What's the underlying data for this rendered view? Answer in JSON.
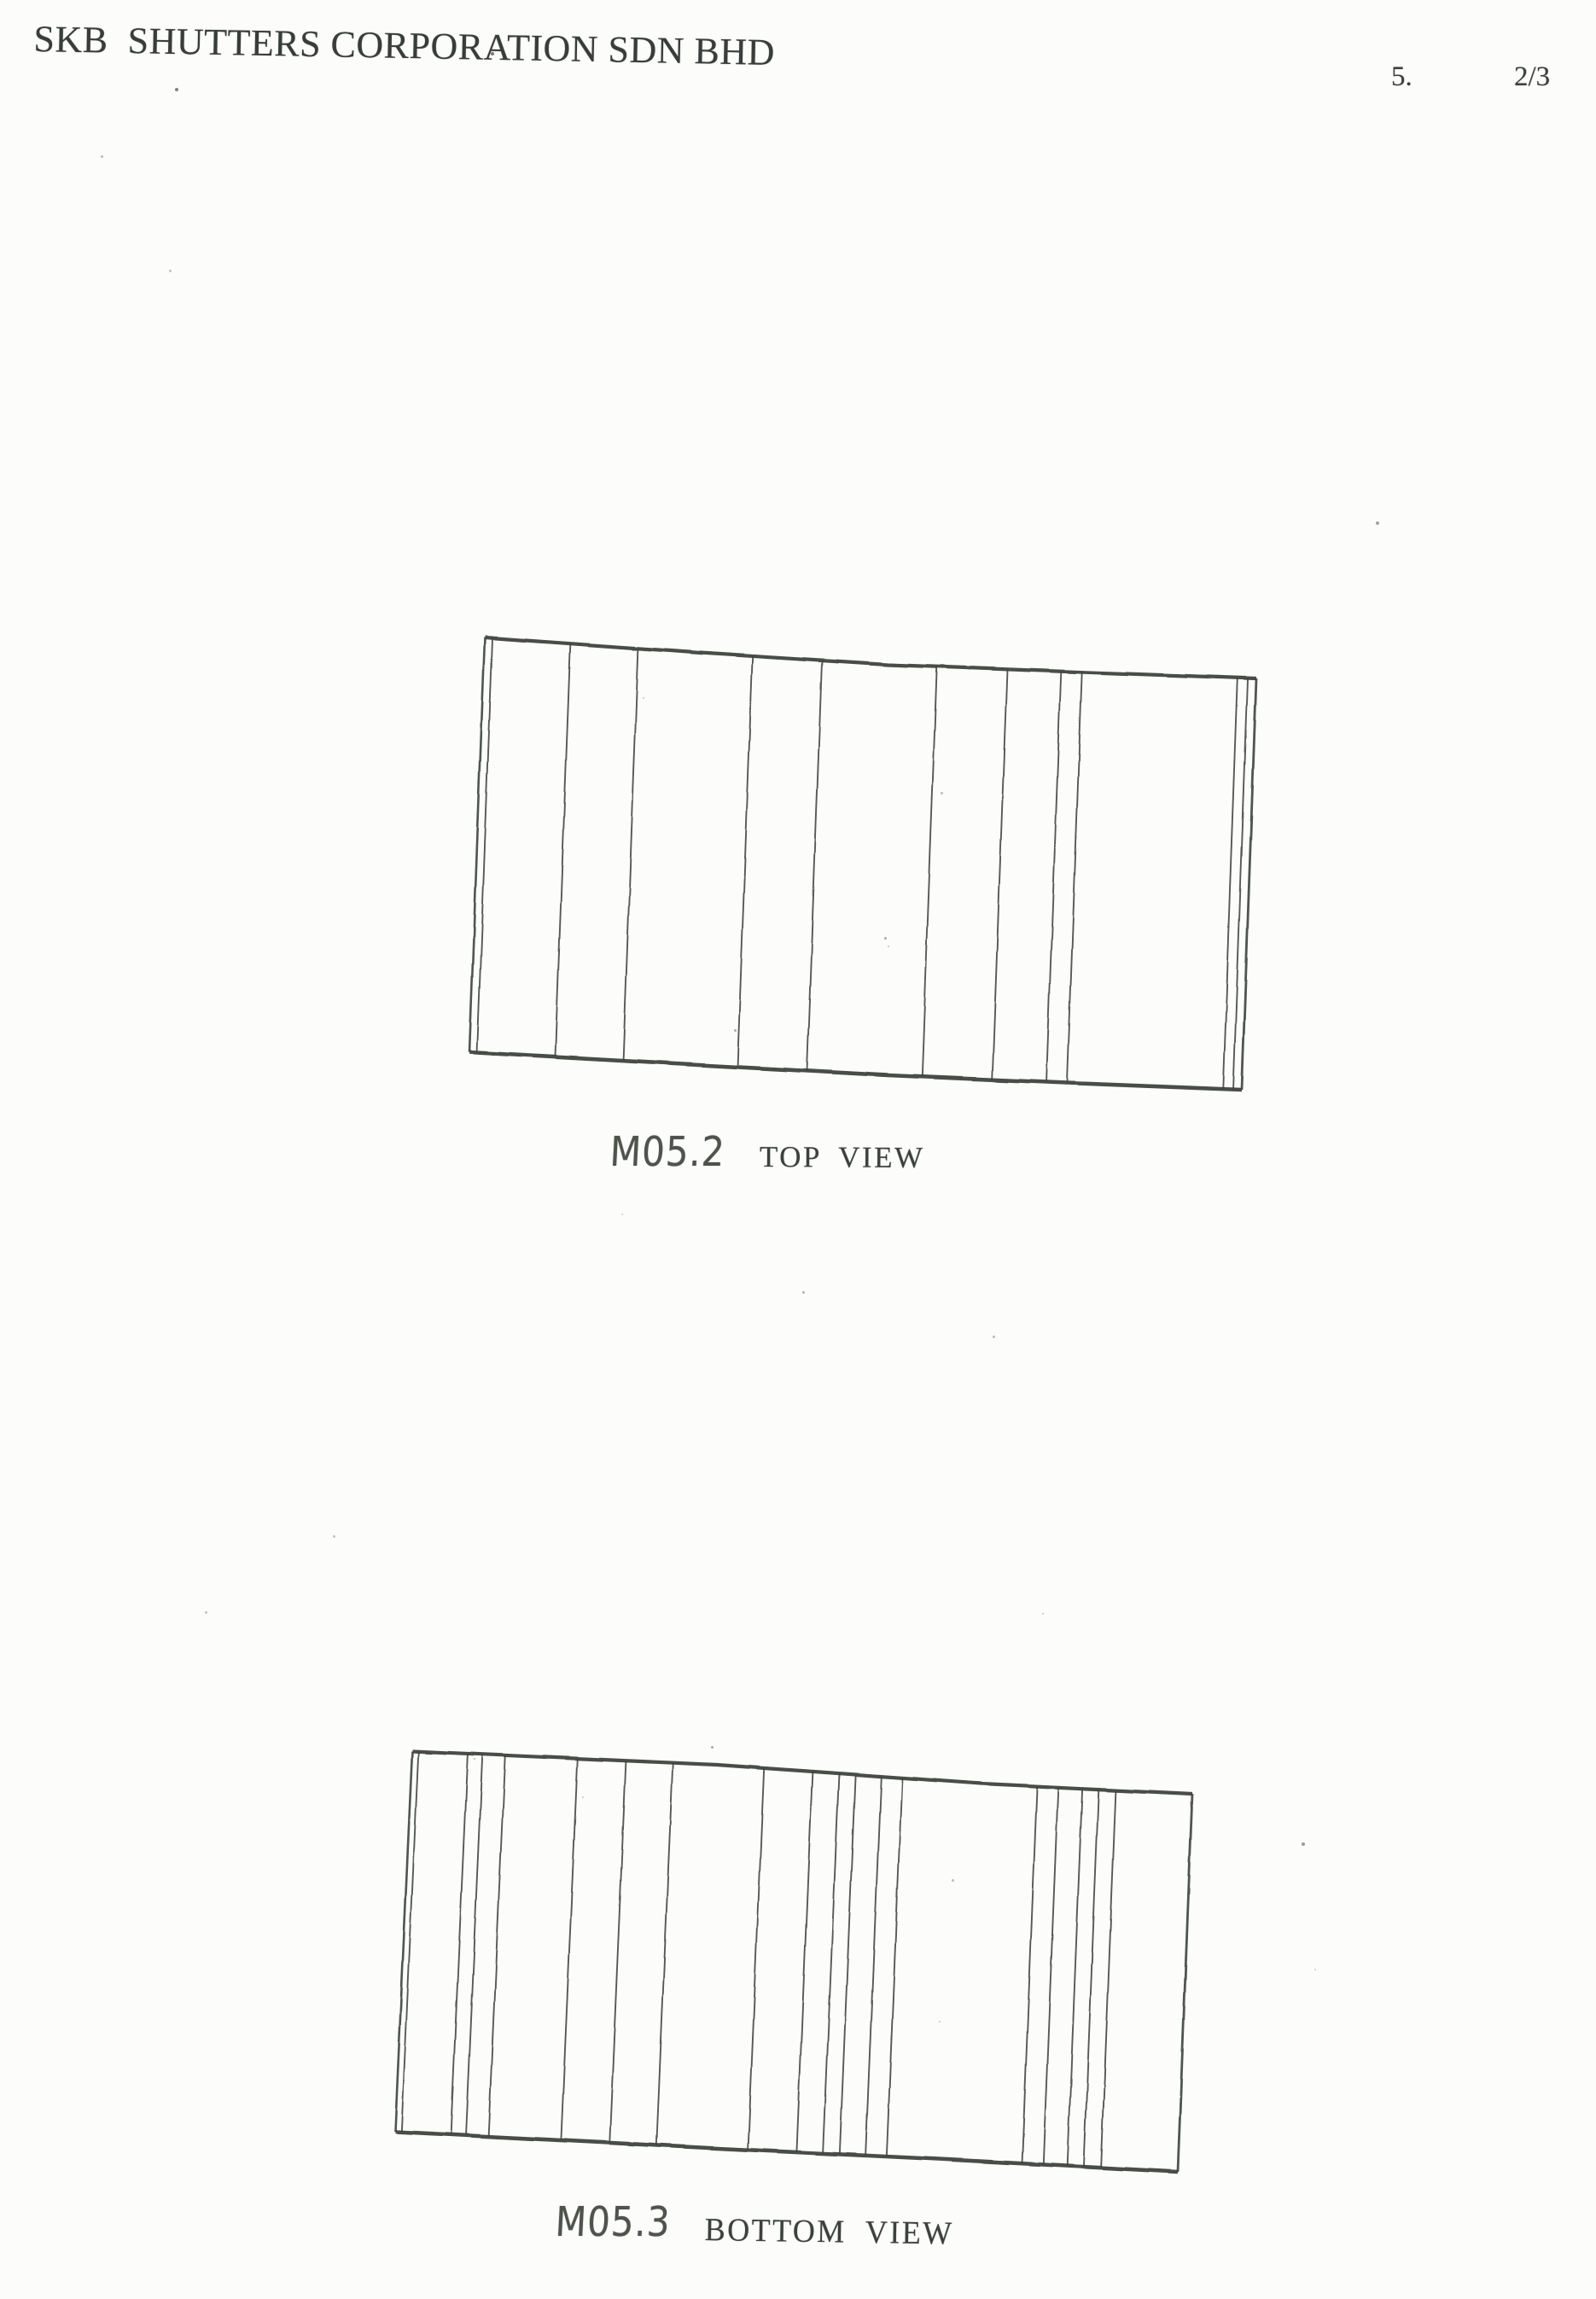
{
  "header": {
    "company": "SKB  SHUTTERS CORPORATION SDN BHD",
    "item_number": "5.",
    "page_indicator": "2/3"
  },
  "figures": [
    {
      "label": "M05.2",
      "title": "TOP VIEW",
      "geometry": {
        "top_edge": [
          [
            568,
            747
          ],
          [
            820,
            765
          ],
          [
            1040,
            779
          ],
          [
            1250,
            787
          ],
          [
            1472,
            795
          ]
        ],
        "bottom_edge": [
          [
            550,
            1233
          ],
          [
            800,
            1247
          ],
          [
            1040,
            1260
          ],
          [
            1250,
            1269
          ],
          [
            1455,
            1277
          ]
        ],
        "panel_line_fractions": [
          0.01,
          0.111,
          0.199,
          0.347,
          0.437,
          0.586,
          0.677,
          0.747,
          0.774,
          0.976,
          0.989
        ]
      }
    },
    {
      "label": "M05.3",
      "title": "BOTTOM VIEW",
      "geometry": {
        "top_edge": [
          [
            483,
            2052
          ],
          [
            840,
            2068
          ],
          [
            1150,
            2090
          ],
          [
            1397,
            2102
          ]
        ],
        "bottom_edge": [
          [
            463,
            2498
          ],
          [
            830,
            2517
          ],
          [
            1100,
            2530
          ],
          [
            1380,
            2545
          ]
        ],
        "panel_line_fractions": [
          0.008,
          0.071,
          0.09,
          0.119,
          0.212,
          0.274,
          0.334,
          0.451,
          0.513,
          0.547,
          0.568,
          0.601,
          0.628,
          0.801,
          0.828,
          0.859,
          0.88,
          0.902
        ]
      }
    }
  ],
  "colors": {
    "ink": "#3e433e",
    "paper": "#fcfcfa"
  },
  "noise_dots": [
    [
      205,
      103,
      4,
      0.75
    ],
    [
      575,
      61,
      4,
      0.8
    ],
    [
      118,
      182,
      3,
      0.4
    ],
    [
      198,
      316,
      3,
      0.35
    ],
    [
      753,
      817,
      2,
      0.35
    ],
    [
      1102,
      928,
      3,
      0.4
    ],
    [
      1612,
      611,
      4,
      0.55
    ],
    [
      1036,
      1098,
      3,
      0.5
    ],
    [
      1040,
      1108,
      2,
      0.4
    ],
    [
      860,
      1206,
      3,
      0.5
    ],
    [
      940,
      1513,
      3,
      0.45
    ],
    [
      728,
      1422,
      2,
      0.3
    ],
    [
      1163,
      1565,
      3,
      0.4
    ],
    [
      1221,
      1890,
      2,
      0.35
    ],
    [
      390,
      1799,
      3,
      0.35
    ],
    [
      240,
      1888,
      3,
      0.35
    ],
    [
      833,
      2046,
      3,
      0.5
    ],
    [
      555,
      2060,
      2,
      0.4
    ],
    [
      682,
      2105,
      2,
      0.35
    ],
    [
      1115,
      2202,
      3,
      0.4
    ],
    [
      1525,
      2159,
      4,
      0.6
    ],
    [
      1540,
      2307,
      2,
      0.3
    ],
    [
      1100,
      2368,
      2,
      0.35
    ]
  ]
}
